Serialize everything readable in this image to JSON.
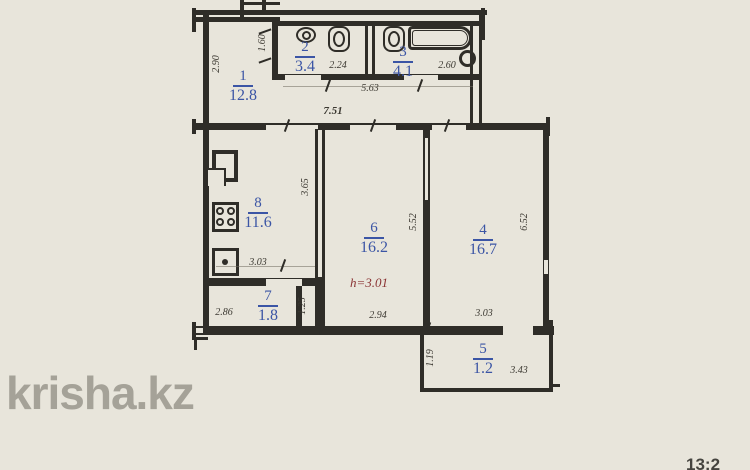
{
  "watermark": "krisha.kz",
  "clock_partial": "13:2",
  "height_note": "h=3.01",
  "colors": {
    "background": "#e8e5db",
    "wall": "#2f2d28",
    "room_label_blue": "#3b55a5",
    "height_note_red": "#8a3333",
    "watermark_gray": "#a5a298"
  },
  "rooms": [
    {
      "number": "1",
      "area": "12.8"
    },
    {
      "number": "2",
      "area": "3.4"
    },
    {
      "number": "3",
      "area": "4.1"
    },
    {
      "number": "4",
      "area": "16.7"
    },
    {
      "number": "5",
      "area": "1.2"
    },
    {
      "number": "6",
      "area": "16.2"
    },
    {
      "number": "7",
      "area": "1.8"
    },
    {
      "number": "8",
      "area": "11.6"
    }
  ],
  "dimensions": {
    "hall_left_height": "2.90",
    "hall_top_width": "1.60",
    "wc_width": "2.24",
    "bath_width": "2.60",
    "hall_corridor_width": "5.63",
    "total_width": "7.51",
    "kitchen_height": "3.65",
    "kitchen_width": "3.03",
    "storage_width": "2.86",
    "storage_height": "1.25",
    "living_width": "2.94",
    "living_height": "5.52",
    "bedroom_width": "3.03",
    "bedroom_height": "6.52",
    "balcony_height": "1.19",
    "balcony_width": "3.43"
  },
  "fixture_icons": [
    "toilet-icon",
    "wc-sink-icon",
    "bath-sink-icon",
    "bathtub-icon",
    "water-heater-icon",
    "counter-icon",
    "stove-icon",
    "kitchen-sink-icon"
  ]
}
